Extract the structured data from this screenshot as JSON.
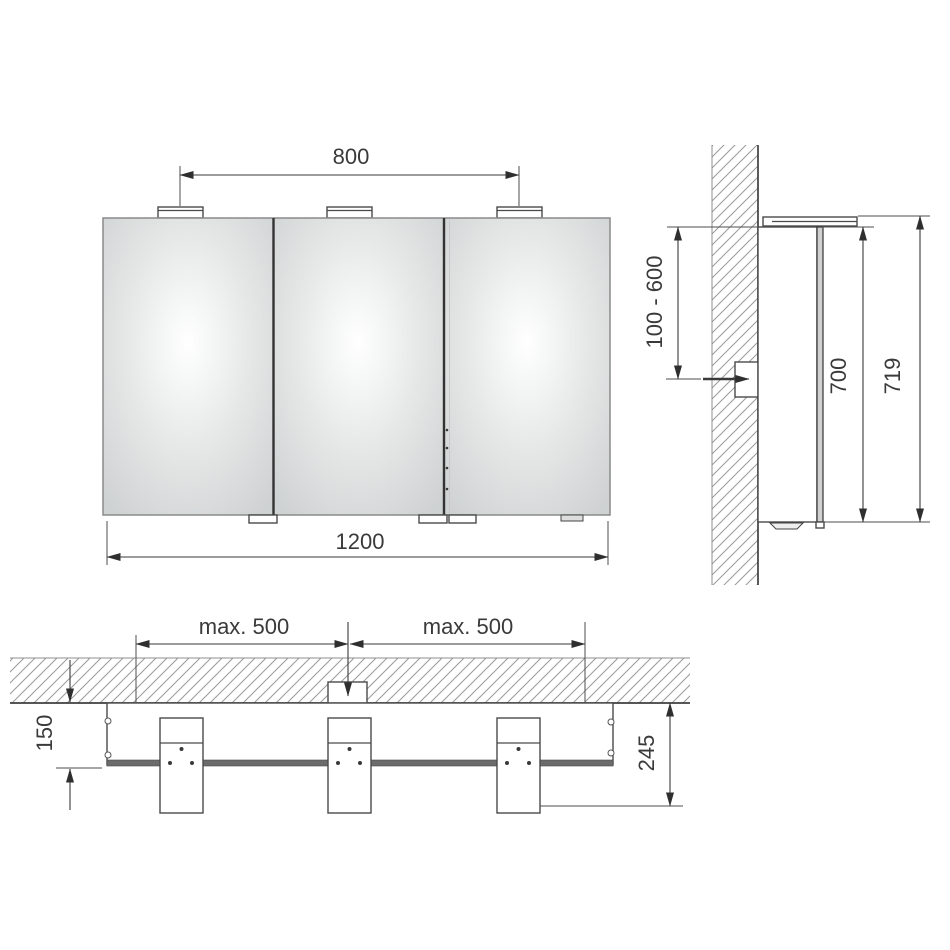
{
  "views": {
    "front": {
      "light_spacing_label": "800",
      "total_width_label": "1200"
    },
    "side": {
      "outlet_height_range_label": "100 - 600",
      "cabinet_height_label": "700",
      "total_height_label": "719"
    },
    "plan": {
      "left_spacing_label": "max. 500",
      "right_spacing_label": "max. 500",
      "cabinet_depth_label": "150",
      "total_depth_label": "245"
    }
  },
  "colors": {
    "background": "#ffffff",
    "line": "#3a3a3a",
    "hatch": "#9a9a9a",
    "mirror_fill": "#d2d4d4",
    "mirror_highlight": "#ffffff",
    "mounting_rail": "#6b6b6b"
  }
}
